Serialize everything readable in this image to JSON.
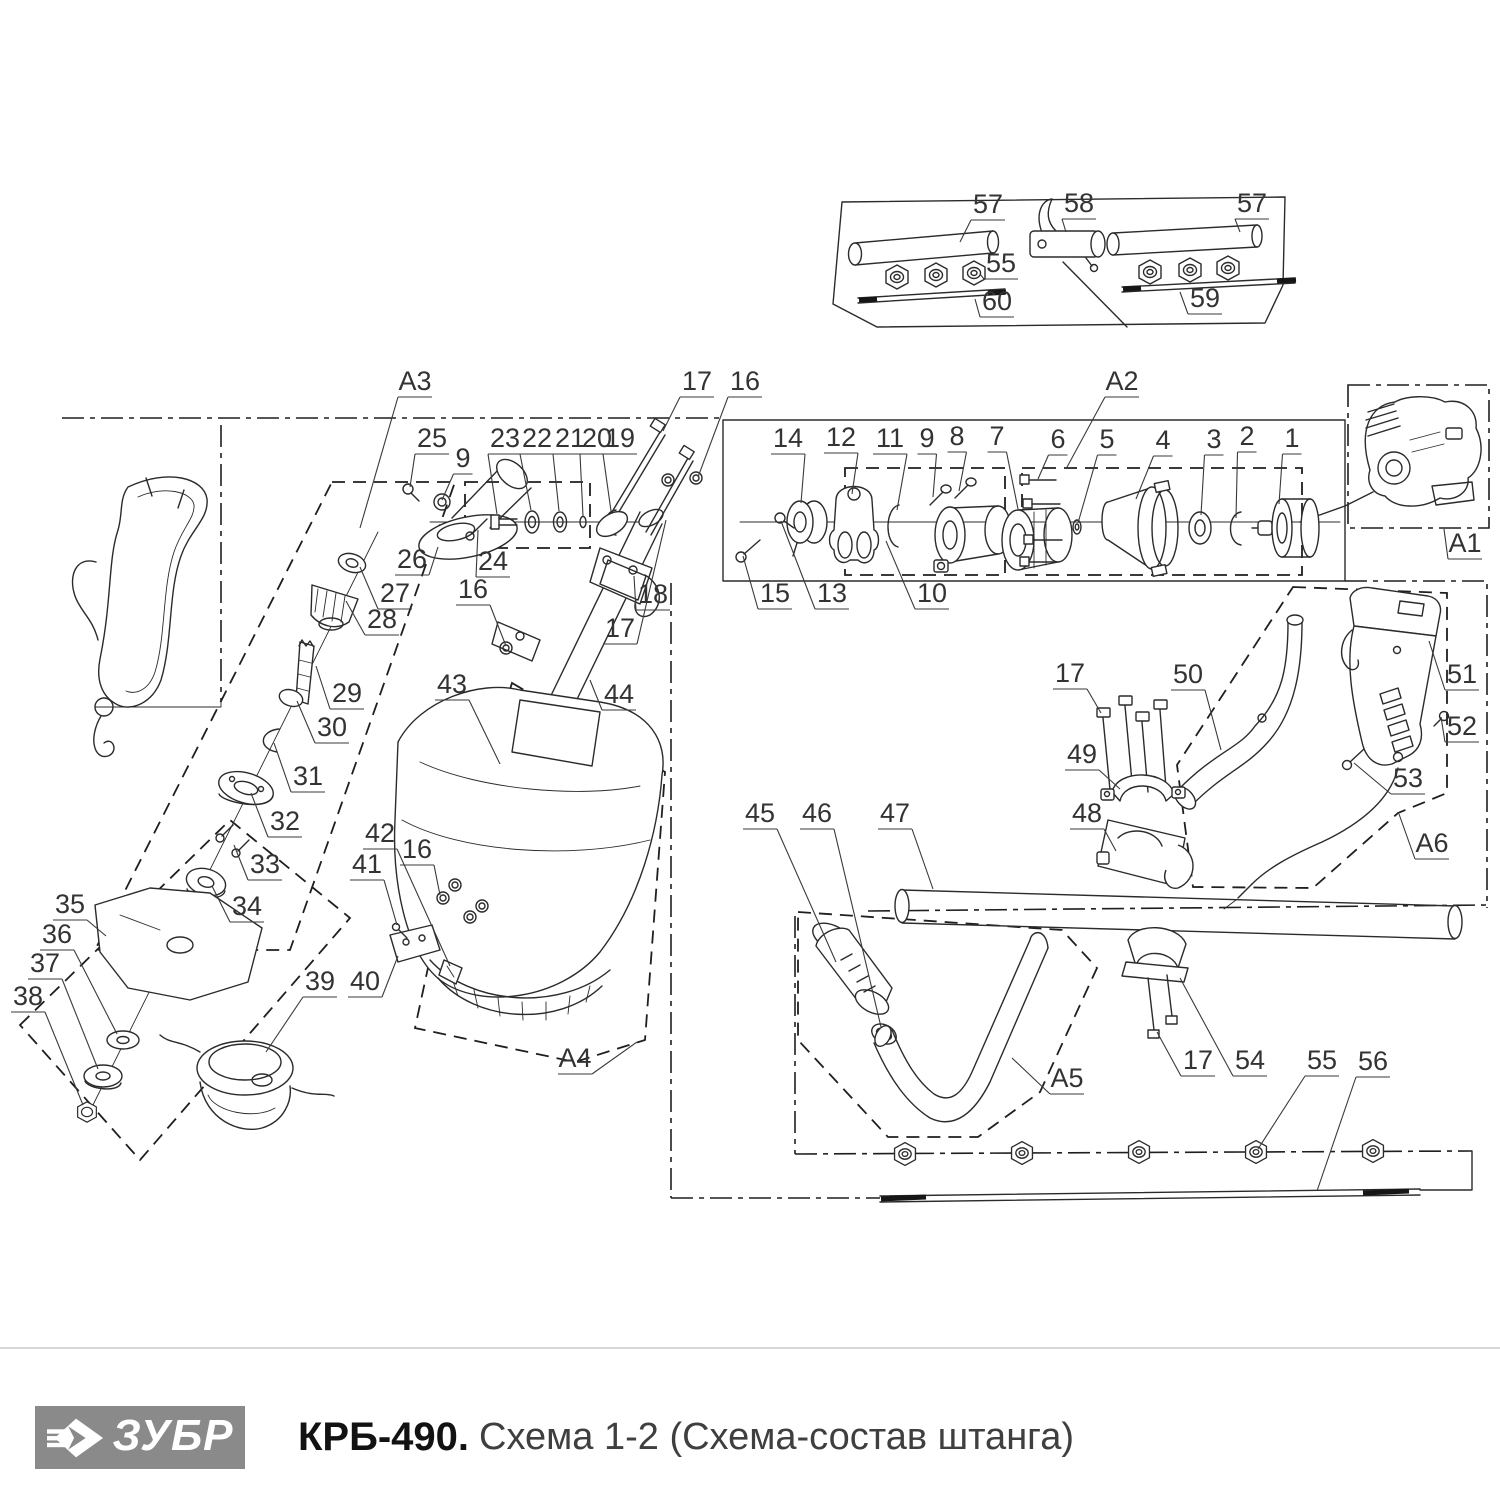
{
  "meta": {
    "ink_color": "#2b2b2b",
    "label_color": "#333333",
    "logo_bg": "#8a8a8a",
    "separator_color": "#d8d8d8",
    "background": "#ffffff"
  },
  "footer": {
    "brand": "ЗУБР",
    "model": "КРБ-490.",
    "subtitle": "Схема 1-2 (Схема-состав штанга)"
  },
  "labels": [
    {
      "t": "57",
      "x": 988,
      "y": 213,
      "tx": 960,
      "ty": 242
    },
    {
      "t": "58",
      "x": 1079,
      "y": 212,
      "tx": 1066,
      "ty": 232
    },
    {
      "t": "57",
      "x": 1252,
      "y": 212,
      "tx": 1240,
      "ty": 232
    },
    {
      "t": "55",
      "x": 1001,
      "y": 272,
      "tx": 980,
      "ty": 274
    },
    {
      "t": "60",
      "x": 997,
      "y": 310,
      "tx": 975,
      "ty": 299
    },
    {
      "t": "59",
      "x": 1205,
      "y": 307,
      "tx": 1180,
      "ty": 292
    },
    {
      "t": "A3",
      "x": 415,
      "y": 390,
      "tx": 360,
      "ty": 528
    },
    {
      "t": "25",
      "x": 432,
      "y": 447,
      "tx": 410,
      "ty": 487
    },
    {
      "t": "9",
      "x": 463,
      "y": 467,
      "tx": 442,
      "ty": 500
    },
    {
      "t": "23",
      "x": 505,
      "y": 447,
      "tx": 497,
      "ty": 514
    },
    {
      "t": "22",
      "x": 537,
      "y": 447,
      "tx": 531,
      "ty": 510
    },
    {
      "t": "21",
      "x": 570,
      "y": 447,
      "tx": 559,
      "ty": 511
    },
    {
      "t": "20",
      "x": 597,
      "y": 447,
      "tx": 583,
      "ty": 516
    },
    {
      "t": "19",
      "x": 620,
      "y": 447,
      "tx": 611,
      "ty": 511
    },
    {
      "t": "26",
      "x": 412,
      "y": 568,
      "tx": 438,
      "ty": 547
    },
    {
      "t": "24",
      "x": 493,
      "y": 570,
      "tx": 478,
      "ty": 530
    },
    {
      "t": "27",
      "x": 395,
      "y": 602,
      "tx": 360,
      "ty": 567
    },
    {
      "t": "28",
      "x": 382,
      "y": 628,
      "tx": 346,
      "ty": 601
    },
    {
      "t": "16",
      "x": 473,
      "y": 598,
      "tx": 506,
      "ty": 646
    },
    {
      "t": "29",
      "x": 347,
      "y": 702,
      "tx": 316,
      "ty": 666
    },
    {
      "t": "30",
      "x": 332,
      "y": 736,
      "tx": 297,
      "ty": 701
    },
    {
      "t": "31",
      "x": 308,
      "y": 785,
      "tx": 274,
      "ty": 743
    },
    {
      "t": "32",
      "x": 285,
      "y": 830,
      "tx": 251,
      "ty": 793
    },
    {
      "t": "33",
      "x": 265,
      "y": 873,
      "tx": 234,
      "ty": 845
    },
    {
      "t": "34",
      "x": 247,
      "y": 915,
      "tx": 212,
      "ty": 886
    },
    {
      "t": "35",
      "x": 70,
      "y": 913,
      "tx": 106,
      "ty": 936
    },
    {
      "t": "36",
      "x": 57,
      "y": 943,
      "tx": 117,
      "ty": 1034
    },
    {
      "t": "37",
      "x": 45,
      "y": 972,
      "tx": 98,
      "ty": 1069
    },
    {
      "t": "38",
      "x": 28,
      "y": 1005,
      "tx": 83,
      "ty": 1105
    },
    {
      "t": "39",
      "x": 320,
      "y": 990,
      "tx": 266,
      "ty": 1052
    },
    {
      "t": "40",
      "x": 365,
      "y": 990,
      "tx": 398,
      "ty": 956
    },
    {
      "t": "41",
      "x": 367,
      "y": 873,
      "tx": 397,
      "ty": 925
    },
    {
      "t": "42",
      "x": 380,
      "y": 842,
      "tx": 450,
      "ty": 966
    },
    {
      "t": "16",
      "x": 417,
      "y": 858,
      "tx": 440,
      "ty": 895
    },
    {
      "t": "43",
      "x": 452,
      "y": 693,
      "tx": 500,
      "ty": 764
    },
    {
      "t": "44",
      "x": 619,
      "y": 703,
      "tx": 590,
      "ty": 680
    },
    {
      "t": "A4",
      "x": 575,
      "y": 1067,
      "tx": 637,
      "ty": 1042
    },
    {
      "t": "17",
      "x": 697,
      "y": 390,
      "tx": 663,
      "ty": 431
    },
    {
      "t": "16",
      "x": 745,
      "y": 390,
      "tx": 698,
      "ty": 477
    },
    {
      "t": "18",
      "x": 653,
      "y": 603,
      "tx": 634,
      "ty": 576
    },
    {
      "t": "17",
      "x": 620,
      "y": 637,
      "tx": 666,
      "ty": 520
    },
    {
      "t": "14",
      "x": 788,
      "y": 447,
      "tx": 801,
      "ty": 503
    },
    {
      "t": "12",
      "x": 841,
      "y": 446,
      "tx": 852,
      "ty": 494
    },
    {
      "t": "11",
      "x": 890,
      "y": 447,
      "tx": 897,
      "ty": 510
    },
    {
      "t": "9",
      "x": 927,
      "y": 447,
      "tx": 933,
      "ty": 497
    },
    {
      "t": "8",
      "x": 957,
      "y": 445,
      "tx": 959,
      "ty": 491
    },
    {
      "t": "7",
      "x": 997,
      "y": 445,
      "tx": 1018,
      "ty": 509
    },
    {
      "t": "6",
      "x": 1058,
      "y": 448,
      "tx": 1038,
      "ty": 479
    },
    {
      "t": "5",
      "x": 1107,
      "y": 448,
      "tx": 1078,
      "ty": 523
    },
    {
      "t": "4",
      "x": 1163,
      "y": 449,
      "tx": 1136,
      "ty": 499
    },
    {
      "t": "3",
      "x": 1214,
      "y": 448,
      "tx": 1201,
      "ty": 515
    },
    {
      "t": "2",
      "x": 1247,
      "y": 445,
      "tx": 1236,
      "ty": 518
    },
    {
      "t": "1",
      "x": 1292,
      "y": 447,
      "tx": 1279,
      "ty": 504
    },
    {
      "t": "15",
      "x": 775,
      "y": 602,
      "tx": 743,
      "ty": 556
    },
    {
      "t": "13",
      "x": 832,
      "y": 602,
      "tx": 781,
      "ty": 521
    },
    {
      "t": "10",
      "x": 932,
      "y": 602,
      "tx": 886,
      "ty": 541
    },
    {
      "t": "A2",
      "x": 1122,
      "y": 390,
      "tx": 1066,
      "ty": 469
    },
    {
      "t": "A1",
      "x": 1465,
      "y": 552,
      "tx": 1444,
      "ty": 529
    },
    {
      "t": "17",
      "x": 1070,
      "y": 682,
      "tx": 1101,
      "ty": 713
    },
    {
      "t": "50",
      "x": 1188,
      "y": 683,
      "tx": 1221,
      "ty": 750
    },
    {
      "t": "51",
      "x": 1462,
      "y": 683,
      "tx": 1429,
      "ty": 641
    },
    {
      "t": "52",
      "x": 1462,
      "y": 735,
      "tx": 1441,
      "ty": 717
    },
    {
      "t": "53",
      "x": 1408,
      "y": 787,
      "tx": 1354,
      "ty": 763
    },
    {
      "t": "49",
      "x": 1082,
      "y": 763,
      "tx": 1120,
      "ty": 789
    },
    {
      "t": "48",
      "x": 1087,
      "y": 822,
      "tx": 1116,
      "ty": 851
    },
    {
      "t": "A6",
      "x": 1432,
      "y": 852,
      "tx": 1399,
      "ty": 814
    },
    {
      "t": "45",
      "x": 760,
      "y": 822,
      "tx": 836,
      "ty": 962
    },
    {
      "t": "46",
      "x": 817,
      "y": 822,
      "tx": 881,
      "ty": 1027
    },
    {
      "t": "47",
      "x": 895,
      "y": 822,
      "tx": 933,
      "ty": 889
    },
    {
      "t": "A5",
      "x": 1067,
      "y": 1087,
      "tx": 1012,
      "ty": 1058
    },
    {
      "t": "17",
      "x": 1198,
      "y": 1069,
      "tx": 1157,
      "ty": 1032
    },
    {
      "t": "54",
      "x": 1250,
      "y": 1069,
      "tx": 1180,
      "ty": 978
    },
    {
      "t": "55",
      "x": 1322,
      "y": 1069,
      "tx": 1258,
      "ty": 1149
    },
    {
      "t": "56",
      "x": 1373,
      "y": 1070,
      "tx": 1317,
      "ty": 1191
    }
  ]
}
